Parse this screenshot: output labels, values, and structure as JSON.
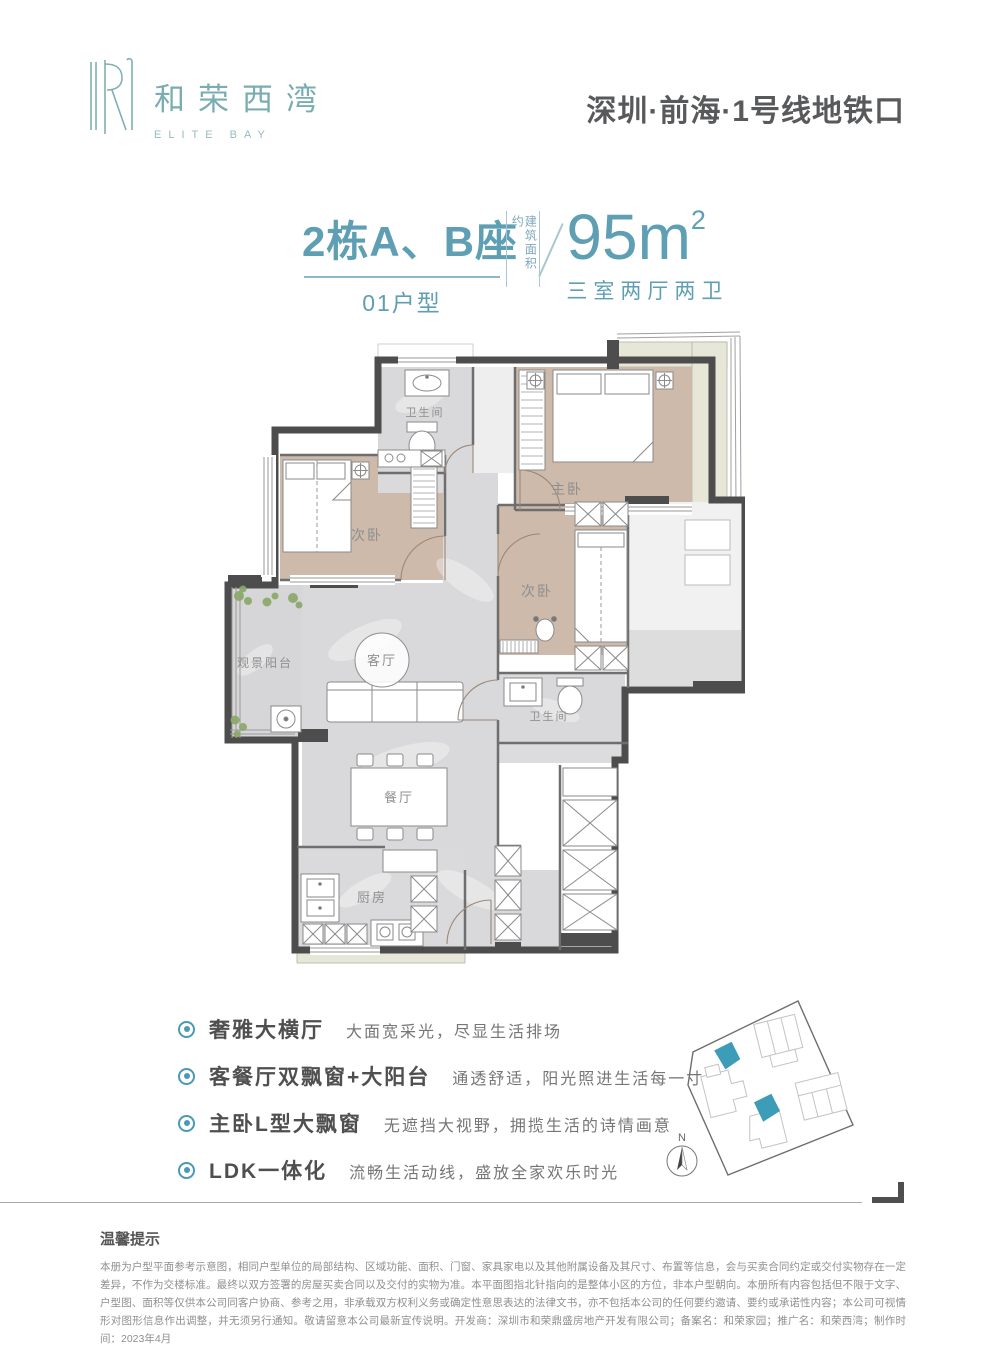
{
  "header": {
    "logo_cn": "和荣西湾",
    "logo_en": "ELITE BAY",
    "location": "深圳·前海·1号线地铁口"
  },
  "title": {
    "building": "2栋A、B座",
    "unit": "01户型",
    "area_label": "建筑面积约",
    "area_value": "95m",
    "area_sup": "2",
    "layout": "三室两厅两卫"
  },
  "floorplan": {
    "rooms": {
      "bath1": "卫生间",
      "master": "主卧",
      "bed2": "次卧",
      "bed3": "次卧",
      "balcony": "观景阳台",
      "living": "客厅",
      "bath2": "卫生间",
      "dining": "餐厅",
      "kitchen": "厨房"
    }
  },
  "features": [
    {
      "title": "奢雅大横厅",
      "desc": "大面宽采光，尽显生活排场"
    },
    {
      "title": "客餐厅双飘窗+大阳台",
      "desc": "通透舒适，阳光照进生活每一寸"
    },
    {
      "title": "主卧L型大飘窗",
      "desc": "无遮挡大视野，拥揽生活的诗情画意"
    },
    {
      "title": "LDK一体化",
      "desc": "流畅生活动线，盛放全家欢乐时光"
    }
  ],
  "siteplan": {
    "north": "N"
  },
  "notice": {
    "title": "温馨提示",
    "body": "本册为户型平面参考示意图，相同户型单位的局部结构、区域功能、面积、门窗、家具家电以及其他附属设备及其尺寸、布置等信息，会与买卖合同约定或交付实物存在一定差异，不作为交楼标准。最终以双方签署的房屋买卖合同以及交付的实物为准。本平面图指北针指向的是整体小区的方位，非本户型朝向。本册所有内容包括但不限于文字、户型图、面积等仅供本公司同客户协商、参考之用，非承载双方权利义务或确定性意思表达的法律文书，亦不包括本公司的任何要约邀请、要约或承诺性内容；本公司可视情形对图形信息作出调整，并无须另行通知。敬请留意本公司最新宣传说明。开发商：深圳市和荣鼎盛房地产开发有限公司；备案名：和荣家园；推广名：和荣西湾；制作时间：2023年4月"
  },
  "colors": {
    "accent": "#5E9FB4",
    "logo_teal": "#7FB0B4",
    "wall": "#4D4D4D",
    "wood": "#CDBAAB",
    "marble": "#D9D9DB",
    "bay_green": "#E6E7D7",
    "highlight_teal": "#3D9CB8"
  }
}
